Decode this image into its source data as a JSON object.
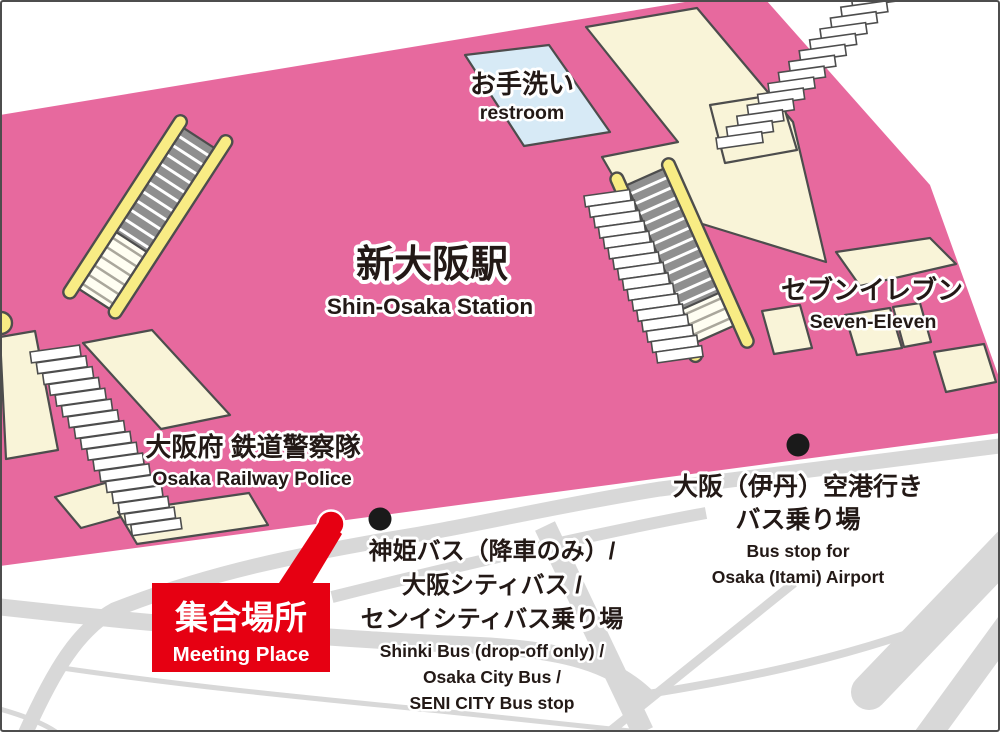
{
  "colors": {
    "pink": "#e7699e",
    "cream": "#f9f4d8",
    "blue": "#d7eaf6",
    "yellow": "#f8ec84",
    "red": "#e60012",
    "road": "#d8d8d8",
    "outline": "#4d4d4d",
    "step-gray": "#8f8f8f",
    "text": "#231916",
    "white": "#ffffff"
  },
  "station": {
    "name_jp": "新大阪駅",
    "name_en": "Shin-Osaka Station"
  },
  "places": {
    "restroom": {
      "jp": "お手洗い",
      "en": "restroom"
    },
    "seven_eleven": {
      "jp": "セブンイレブン",
      "en": "Seven-Eleven"
    },
    "railway_police": {
      "jp": "大阪府 鉄道警察隊",
      "en": "Osaka Railway Police"
    },
    "meeting_place": {
      "jp": "集合場所",
      "en": "Meeting Place"
    }
  },
  "bus_stops": {
    "shinki": {
      "jp_lines": [
        "神姫バス（降車のみ）/",
        "大阪シティバス /",
        "センイシティバス乗り場"
      ],
      "en_lines": [
        "Shinki Bus (drop-off only) /",
        "Osaka City Bus /",
        "SENI CITY Bus stop"
      ]
    },
    "itami": {
      "jp_lines": [
        "大阪（伊丹）空港行き",
        "バス乗り場"
      ],
      "en_lines": [
        "Bus stop for",
        "Osaka (Itami) Airport"
      ]
    }
  }
}
